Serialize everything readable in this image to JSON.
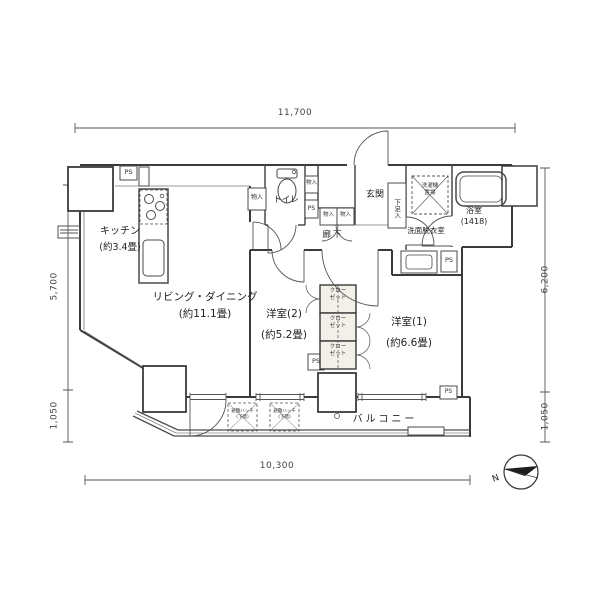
{
  "dims": {
    "top": "11,700",
    "bottom": "10,300",
    "left_upper": "5,700",
    "left_lower": "1,050",
    "right_upper": "6,200",
    "right_lower": "1,050"
  },
  "rooms": {
    "kitchen": {
      "name": "キッチン",
      "size": "(約3.4畳)"
    },
    "living": {
      "name": "リビング・ダイニング",
      "size": "(約11.1畳)"
    },
    "bedroom2": {
      "name": "洋室(2)",
      "size": "(約5.2畳)"
    },
    "bedroom1": {
      "name": "洋室(1)",
      "size": "(約6.6畳)"
    },
    "balcony": {
      "name": "バルコニー"
    },
    "entrance": {
      "name": "玄関"
    },
    "hallway": {
      "name": "廊下"
    },
    "toilet": {
      "name": "トイレ"
    },
    "washroom": {
      "name": "洗面脱衣室"
    },
    "bathroom": {
      "name": "浴室",
      "size": "(1418)"
    }
  },
  "labels": {
    "ps": "PS",
    "storage": "物入",
    "shoe_box": "下足入",
    "closet": [
      "クロー",
      "ゼット"
    ],
    "washer": [
      "洗濯機",
      "置場"
    ],
    "hatch": [
      "避難ハッチ",
      "(下階)"
    ],
    "north": "N"
  },
  "colors": {
    "line": "#4a4a4a",
    "wall": "#3b3b3b",
    "closet_fill": "#f3efe9",
    "bg": "#ffffff"
  }
}
